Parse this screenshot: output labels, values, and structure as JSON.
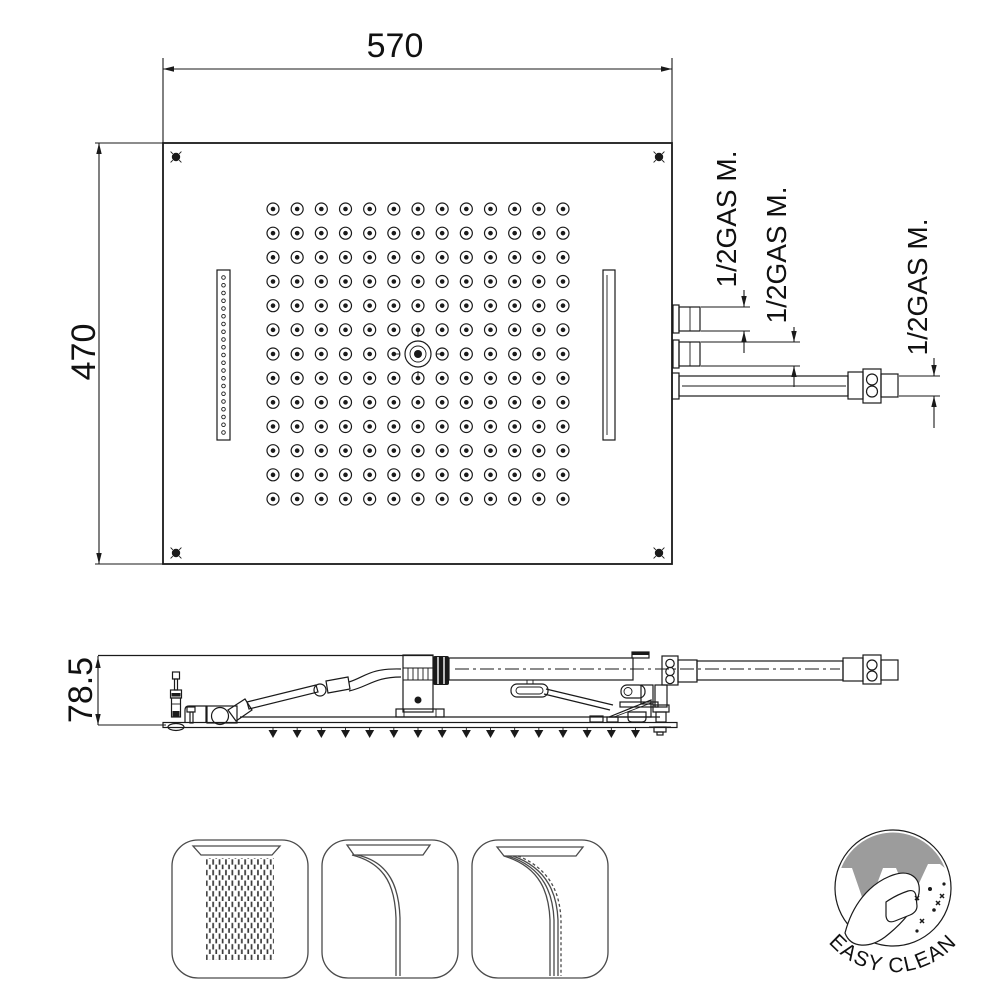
{
  "top_view": {
    "width_dim": "570",
    "height_dim": "470",
    "connections": [
      "1/2GAS M.",
      "1/2GAS M.",
      "1/2GAS M."
    ],
    "nozzle_grid": {
      "rows": 13,
      "cols": 13
    },
    "slot_holes": 21,
    "plate_nozzle_tips": 16
  },
  "side_view": {
    "height_dim": "78.5"
  },
  "icons": [
    {
      "name": "rain-spray-icon"
    },
    {
      "name": "waterfall-stream-icon"
    },
    {
      "name": "cascade-stream-icon"
    }
  ],
  "badge": {
    "label": "EASY CLEAN"
  },
  "colors": {
    "line": "#1a1a1a",
    "badge_gray": "#9c9c9c",
    "bg": "#ffffff"
  }
}
